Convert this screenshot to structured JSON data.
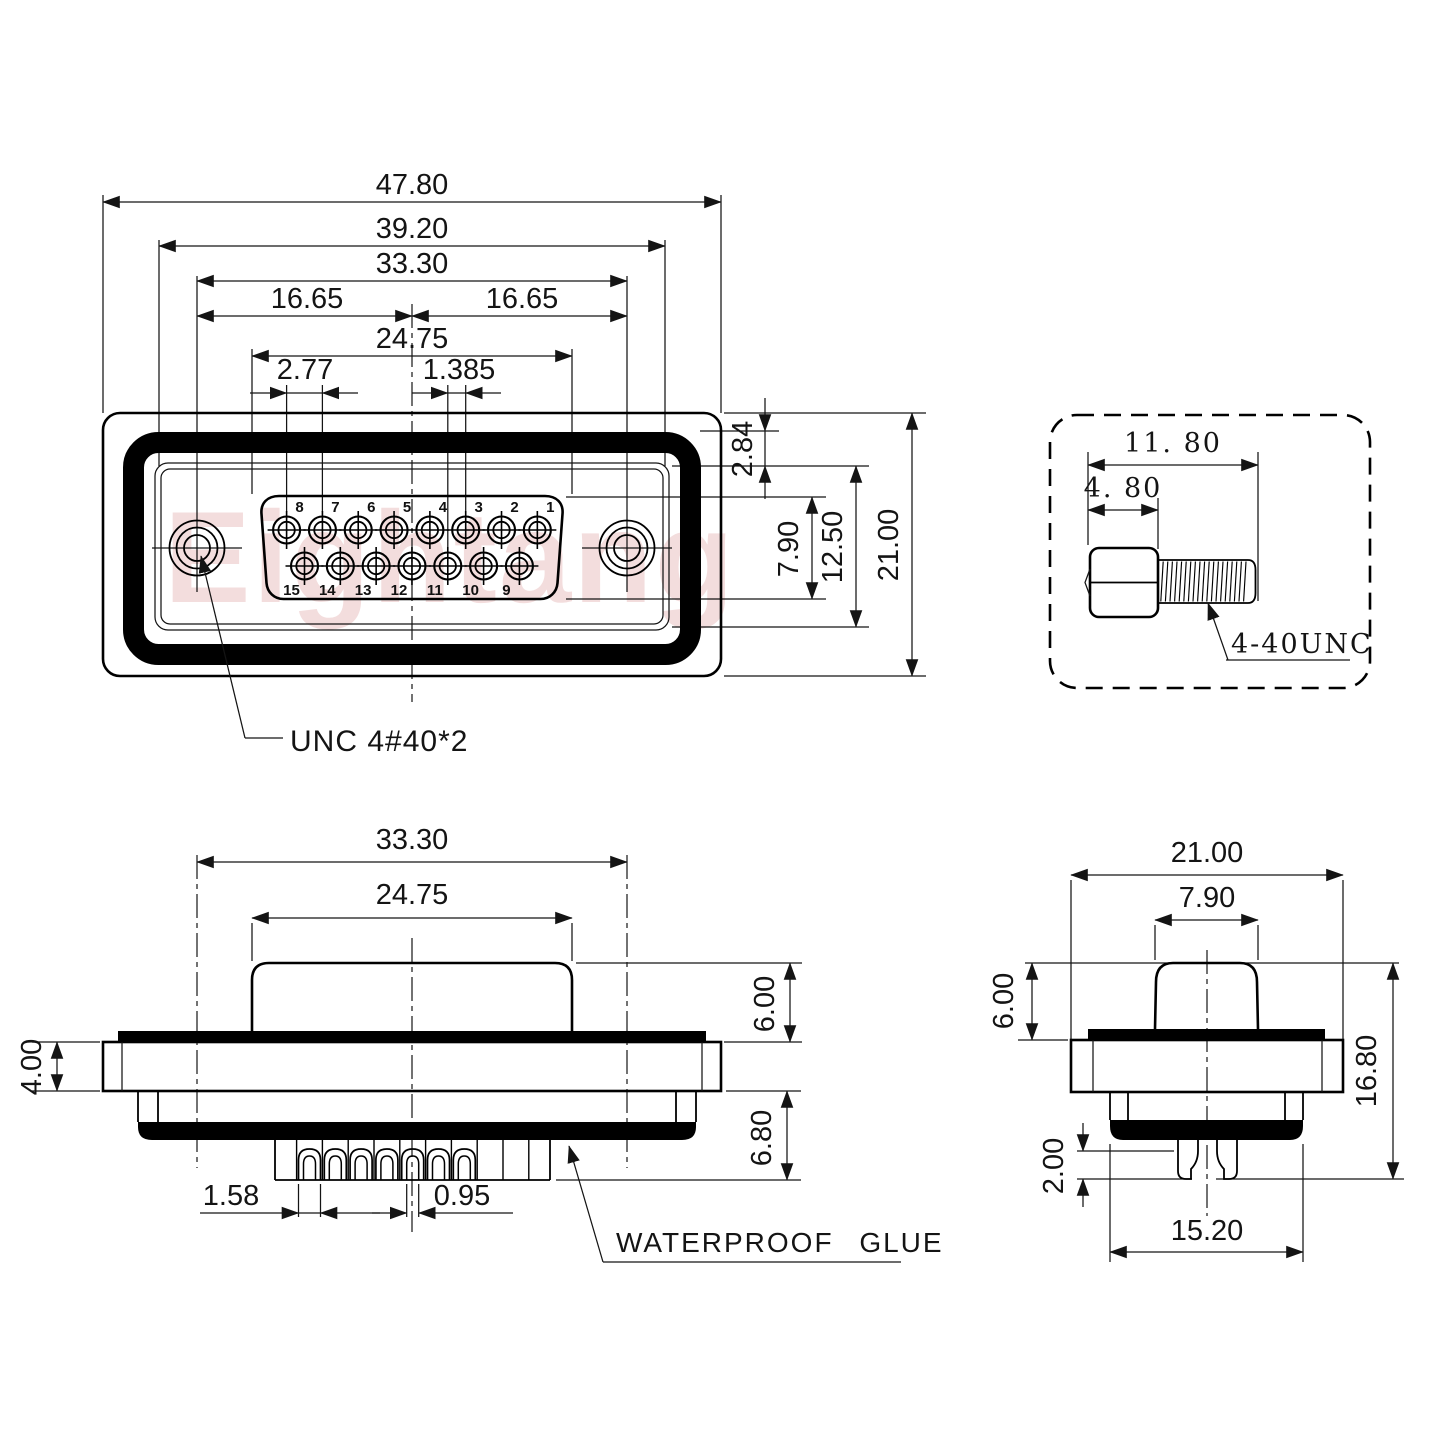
{
  "watermark": {
    "text": "Eightang"
  },
  "front_view": {
    "dim_47_80": "47.80",
    "dim_39_20": "39.20",
    "dim_33_30": "33.30",
    "dim_16_65_left": "16.65",
    "dim_16_65_right": "16.65",
    "dim_24_75": "24.75",
    "dim_2_77": "2.77",
    "dim_1_385": "1.385",
    "dim_2_84": "2.84",
    "dim_7_90": "7.90",
    "dim_12_50": "12.50",
    "dim_21_00": "21.00",
    "screw_label": "UNC 4#40*2",
    "pin_numbers_top": [
      "8",
      "7",
      "6",
      "5",
      "4",
      "3",
      "2",
      "1"
    ],
    "pin_numbers_bottom": [
      "15",
      "14",
      "13",
      "12",
      "11",
      "10",
      "9"
    ]
  },
  "screw_view": {
    "dim_total_length": "11. 80",
    "dim_head_length": "4. 80",
    "thread_label": "4-40UNC"
  },
  "side_view": {
    "dim_33_30": "33.30",
    "dim_24_75": "24.75",
    "dim_6_00": "6.00",
    "dim_4_00": "4.00",
    "dim_6_80": "6.80",
    "dim_1_58": "1.58",
    "dim_0_95": "0.95",
    "glue_label": "WATERPROOF GLUE"
  },
  "end_view": {
    "dim_21_00": "21.00",
    "dim_7_90": "7.90",
    "dim_6_00": "6.00",
    "dim_16_80": "16.80",
    "dim_2_00": "2.00",
    "dim_15_20": "15.20"
  }
}
